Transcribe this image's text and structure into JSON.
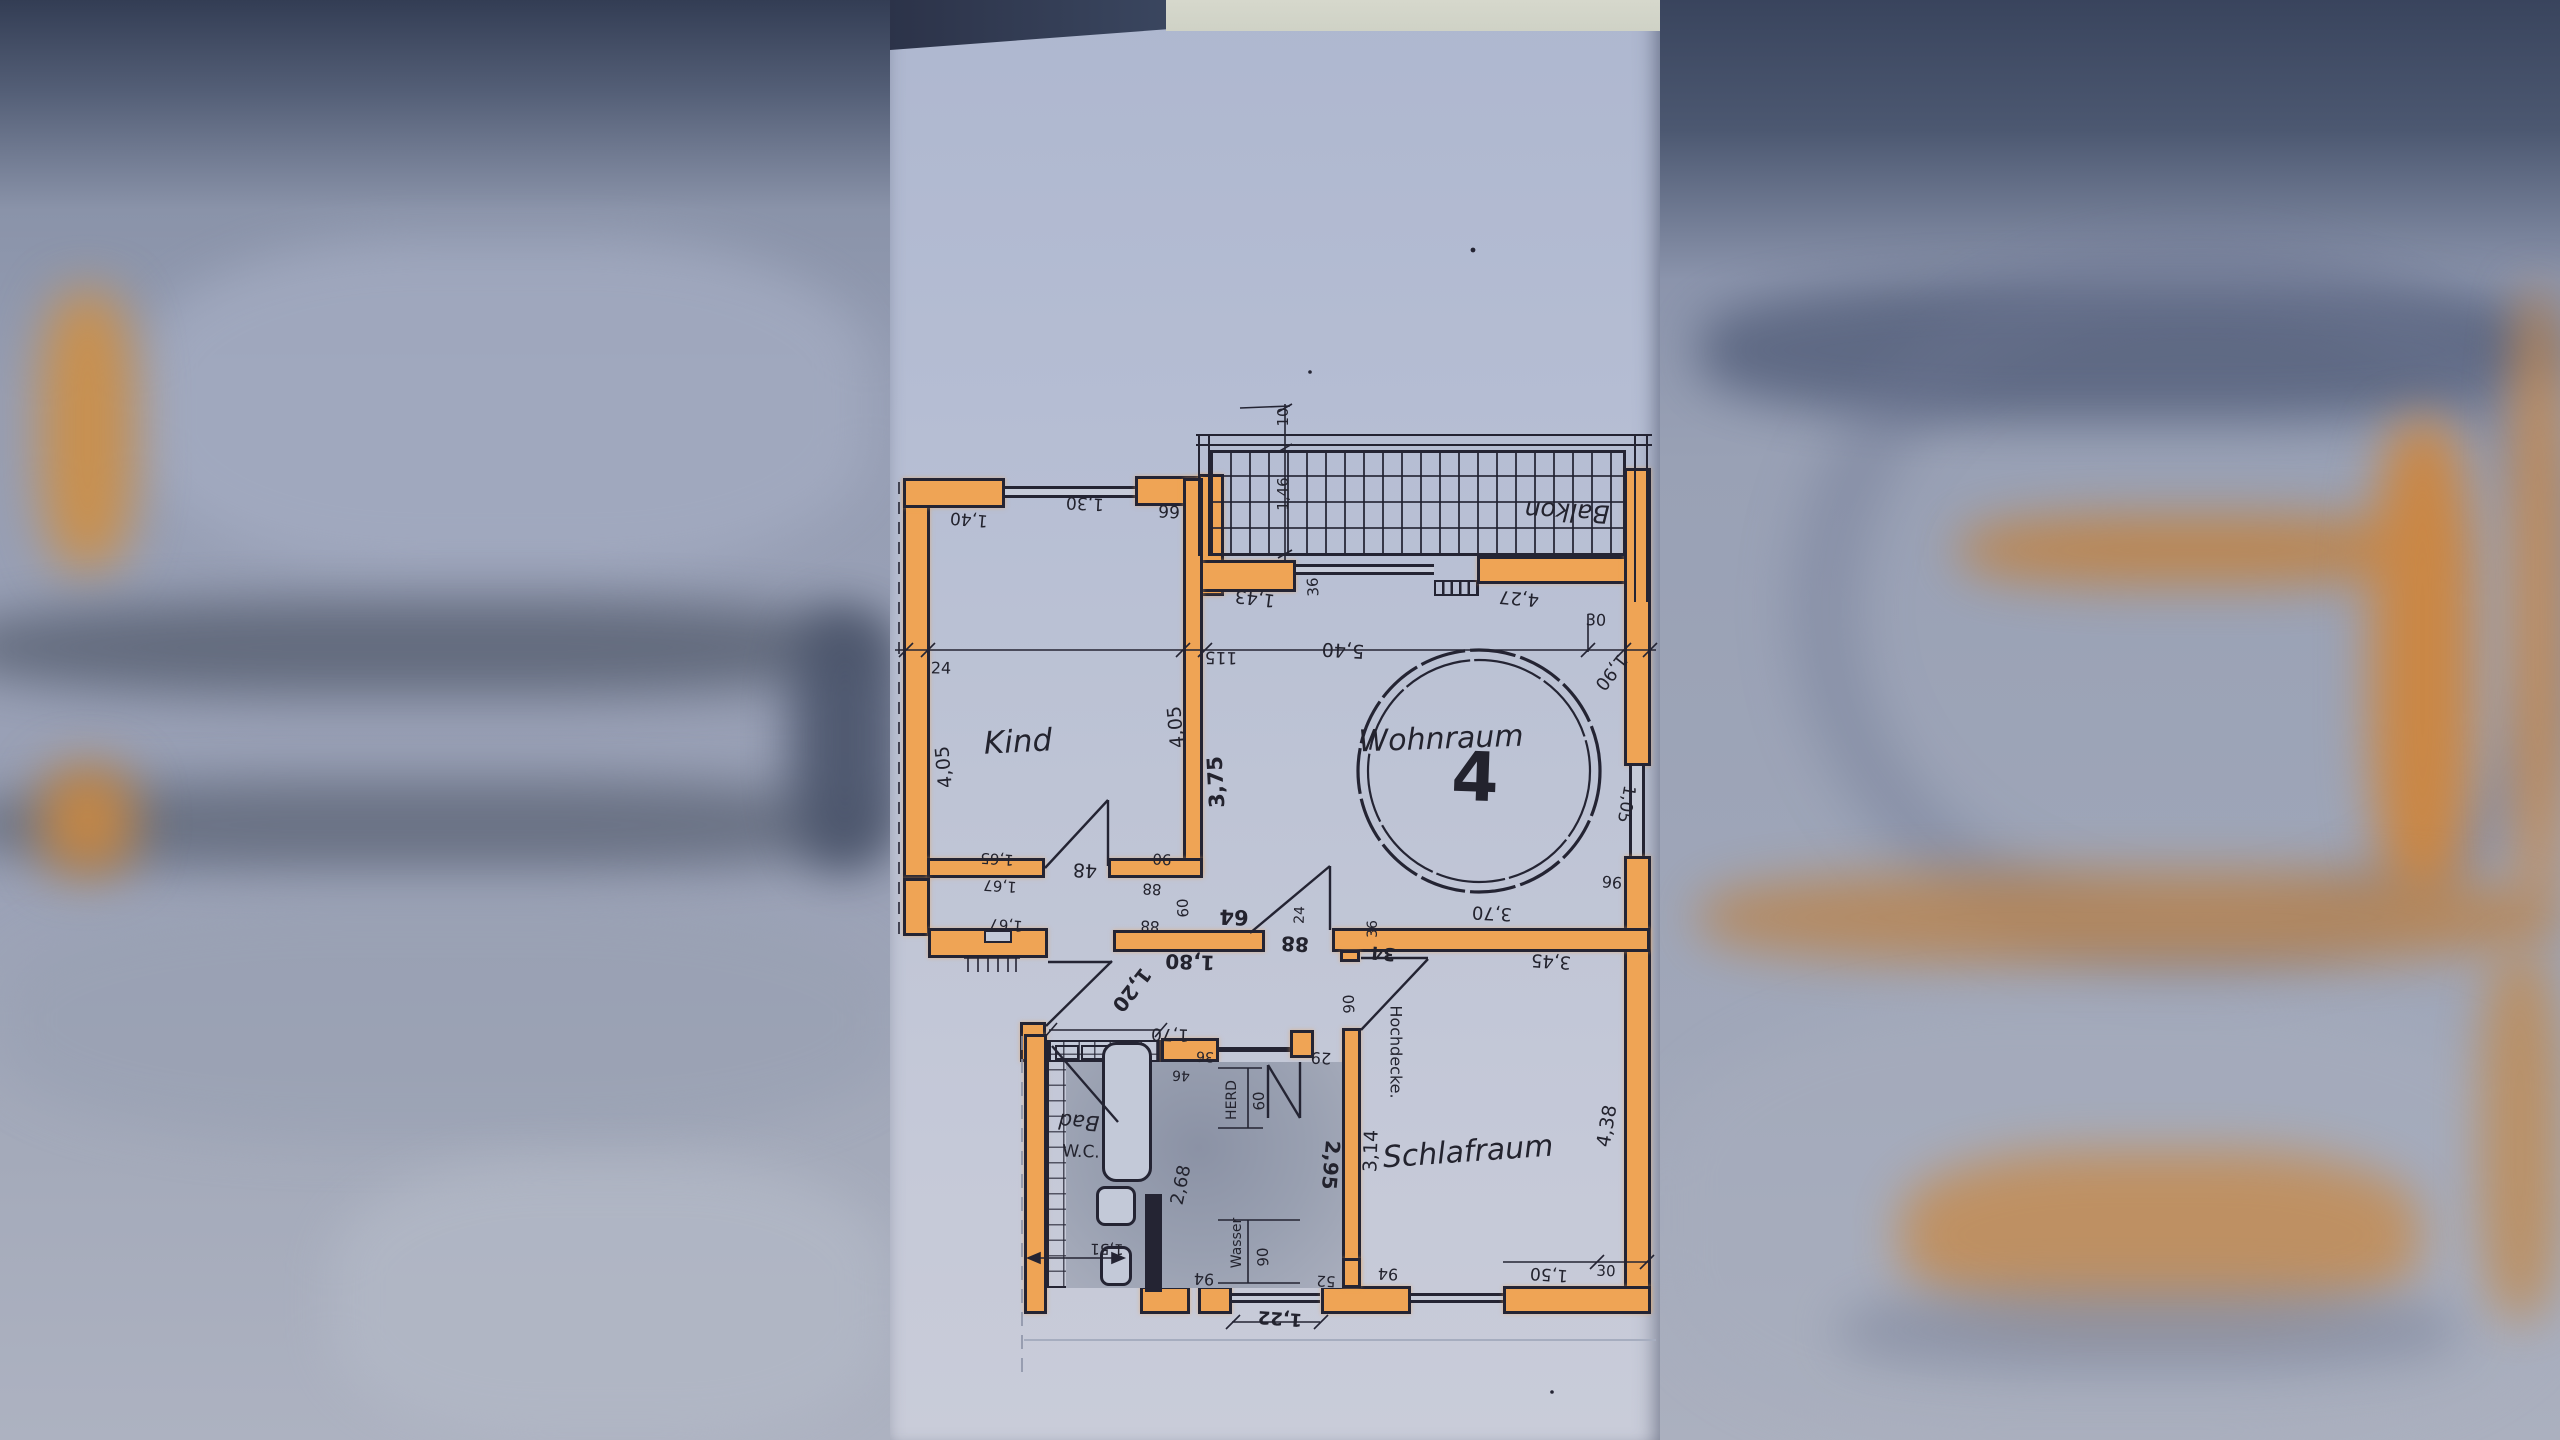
{
  "plan": {
    "unit_number": "4",
    "rooms": {
      "kind": "Kind",
      "wohnraum": "Wohnraum",
      "schlafraum": "Schlafraum",
      "balkon": "Balkon",
      "bad": "Bad",
      "wc": "W.C."
    },
    "fixtures": {
      "herd": "HERD",
      "wasser": "Wasser",
      "hochdecke": "Hochdecke."
    },
    "dims": {
      "kind_width_top_left": "1,40",
      "kind_window_top": "1,30",
      "kind_top_right": "99",
      "kind_height_left": "4,05",
      "kind_height_right": "4,05",
      "kind_inner_height": "3,75",
      "left_wall_seg": "24",
      "top_dim_offset": "115",
      "wohnraum_width": "5,40",
      "right_wall_top": "30",
      "wohnraum_right_upper": "1,90",
      "balcony_rail": "10",
      "balcony_depth": "1,46",
      "balcony_wall_left": "36",
      "balcony_left": "1,43",
      "balcony_right": "4,27",
      "wohnraum_window": "1,05",
      "wohnraum_right_lower": "96",
      "wohnraum_inner_width": "3,70",
      "schlafraum_top": "3,45",
      "wohnraum_bottom_seg": "36",
      "wohnraum_bottom_seg2": "34",
      "hall_door_offset": "24",
      "hall_door_width": "88",
      "hall_niche": "64",
      "hall_length": "1,80",
      "entry_door": "1,20",
      "closet_a": "1,65",
      "closet_b": "1,67",
      "closet_c": "1,67",
      "kind_door": "48",
      "kind_door_width": "90",
      "kind_door_seg": "88",
      "niche_depth": "60",
      "niche_seg": "88",
      "kitchen_counter": "1,70",
      "counter_seg": "36",
      "counter_seg2": "46",
      "herd_width": "60",
      "kitchen_door": "29",
      "schlafraum_door": "90",
      "kitchen_width": "2,95",
      "schlafraum_width": "3,14",
      "schlafraum_height": "4,38",
      "kitchen_depth": "2,68",
      "bath_width": "1,51",
      "water_conn": "90",
      "bottom_seg_a": "94",
      "bottom_seg_b": "52",
      "bottom_seg_c": "94",
      "bottom_entry": "1,22",
      "schlafraum_window": "1,50",
      "bottom_corner": "30"
    }
  },
  "colors": {
    "wall_highlight": "#efa455",
    "ink": "#242433",
    "paper": "#bcc3d5",
    "backdrop": "#969eb4",
    "top_shadow": "#39445d"
  }
}
